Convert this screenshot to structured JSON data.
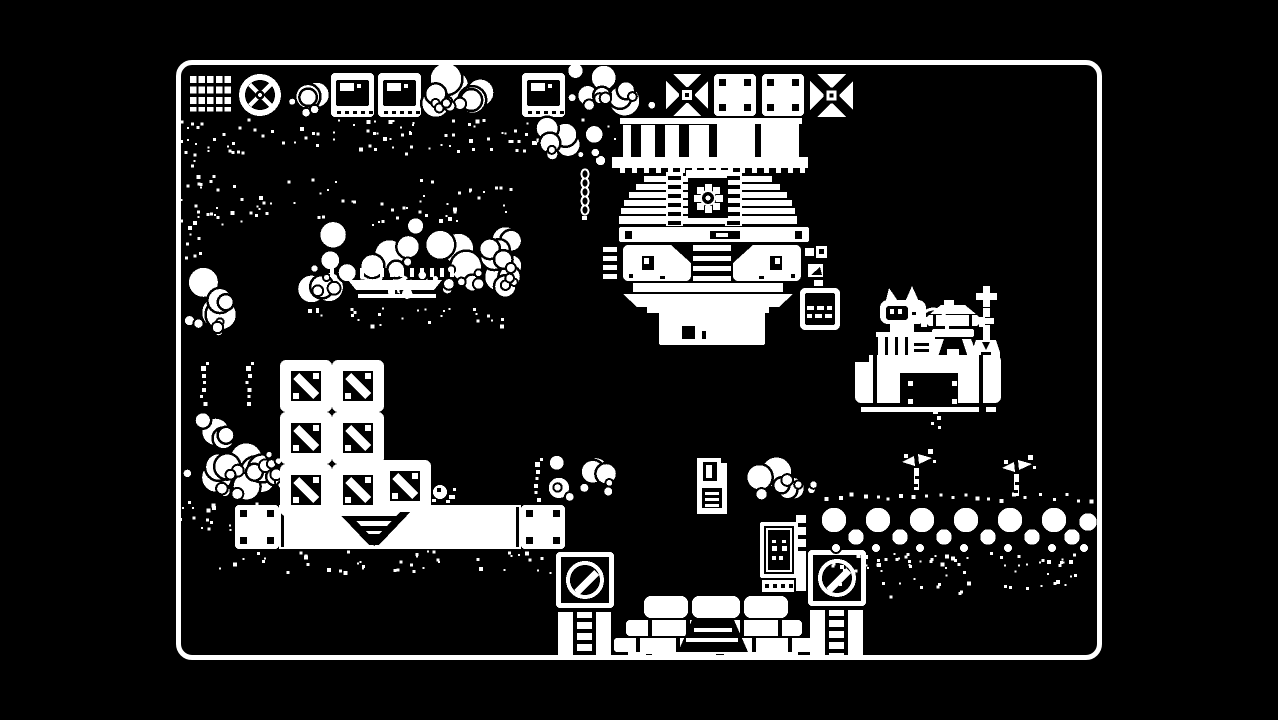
{
  "scene": {
    "description": "1-bit monochrome pixel-art adventure game scene (Minit-style factory area)",
    "colors": {
      "background": "#000000",
      "foreground": "#ffffff"
    },
    "viewport": {
      "x": 176,
      "y": 60,
      "width": 926,
      "height": 600,
      "border_width": 5,
      "border_radius": 16
    },
    "entities": [
      {
        "name": "tile-grid",
        "type": "grid_tile",
        "x": 12,
        "y": 13,
        "w": 44,
        "h": 44
      },
      {
        "name": "tile-wheel",
        "type": "wheel_tile",
        "x": 62,
        "y": 13,
        "w": 44,
        "h": 44
      },
      {
        "name": "foliage-top-a",
        "type": "bubbles",
        "x": 104,
        "y": 10,
        "w": 54,
        "h": 48,
        "seed": 11
      },
      {
        "name": "tile-window-1",
        "type": "window_tile",
        "x": 155,
        "y": 13,
        "w": 43,
        "h": 44
      },
      {
        "name": "tile-window-2",
        "type": "window_tile",
        "x": 202,
        "y": 13,
        "w": 43,
        "h": 44
      },
      {
        "name": "foliage-top-b",
        "type": "bubbles",
        "x": 243,
        "y": 2,
        "w": 102,
        "h": 58,
        "seed": 12
      },
      {
        "name": "tile-window-3",
        "type": "window_tile",
        "x": 346,
        "y": 13,
        "w": 43,
        "h": 44
      },
      {
        "name": "foliage-top-c",
        "type": "bubbles",
        "x": 388,
        "y": 2,
        "w": 100,
        "h": 62,
        "seed": 13
      },
      {
        "name": "tile-x-1",
        "type": "x_tile",
        "x": 490,
        "y": 14,
        "w": 42,
        "h": 42
      },
      {
        "name": "tile-corner-1",
        "type": "corner_tile",
        "x": 538,
        "y": 14,
        "w": 42,
        "h": 42
      },
      {
        "name": "tile-corner-2",
        "type": "corner_tile",
        "x": 586,
        "y": 14,
        "w": 42,
        "h": 42
      },
      {
        "name": "tile-x-2",
        "type": "x_tile",
        "x": 634,
        "y": 14,
        "w": 43,
        "h": 43
      },
      {
        "name": "moss-under-tiles",
        "type": "dither",
        "x": 14,
        "y": 58,
        "w": 430,
        "h": 36,
        "d": 0.05,
        "seed": 21
      },
      {
        "name": "moss-left-edge",
        "type": "dither",
        "x": 0,
        "y": 60,
        "w": 38,
        "h": 150,
        "d": 0.05,
        "seed": 22
      },
      {
        "name": "moss-band-left",
        "type": "dither",
        "x": 18,
        "y": 118,
        "w": 320,
        "h": 46,
        "d": 0.04,
        "seed": 23
      },
      {
        "name": "canopy-mid-left",
        "type": "bubbles",
        "x": 114,
        "y": 148,
        "w": 240,
        "h": 96,
        "seed": 24
      },
      {
        "name": "moss-under-canopy",
        "type": "dither",
        "x": 120,
        "y": 246,
        "w": 230,
        "h": 20,
        "d": 0.05,
        "seed": 25
      },
      {
        "name": "dock-awning",
        "type": "awning",
        "x": 154,
        "y": 206
      },
      {
        "name": "foliage-left-column",
        "type": "bubbles",
        "x": 4,
        "y": 204,
        "w": 62,
        "h": 72,
        "seed": 26
      },
      {
        "name": "foliage-mid",
        "type": "bubbles",
        "x": 358,
        "y": 56,
        "w": 80,
        "h": 56,
        "seed": 27
      },
      {
        "name": "hanging-chain",
        "type": "chain",
        "x": 403,
        "y": 110
      },
      {
        "name": "factory-machine",
        "type": "machine",
        "x": 427,
        "y": 58
      },
      {
        "name": "marquee-sign",
        "type": "marquee",
        "x": 486,
        "y": 254,
        "w": 100,
        "h": 28
      },
      {
        "name": "dot-sign",
        "type": "dot_sign",
        "x": 624,
        "y": 228,
        "w": 40,
        "h": 42
      },
      {
        "name": "cat-npc",
        "type": "cat",
        "x": 704,
        "y": 225
      },
      {
        "name": "grill-machine",
        "type": "grill",
        "x": 750,
        "y": 240
      },
      {
        "name": "lamp-post",
        "type": "lamppost",
        "x": 796,
        "y": 226
      },
      {
        "name": "right-platform",
        "type": "platform_right",
        "x": 679,
        "y": 295,
        "w": 146,
        "h": 48
      },
      {
        "name": "water-drip",
        "type": "drip",
        "x": 753,
        "y": 345
      },
      {
        "name": "hedge-left",
        "type": "bubbles",
        "x": 2,
        "y": 336,
        "w": 112,
        "h": 106,
        "seed": 31
      },
      {
        "name": "moss-under-hedge-left",
        "type": "dither",
        "x": 2,
        "y": 440,
        "w": 116,
        "h": 32,
        "d": 0.06,
        "seed": 32
      },
      {
        "name": "sprout-dots-a",
        "type": "dotstalk",
        "x": 26,
        "y": 306,
        "h": 36,
        "cross": true
      },
      {
        "name": "sprout-dots-b",
        "type": "dotstalk",
        "x": 71,
        "y": 306,
        "h": 36,
        "cross": true
      },
      {
        "name": "left-platform",
        "type": "platform_left",
        "x": 59,
        "y": 445,
        "w": 330,
        "h": 44
      },
      {
        "name": "moss-under-platform",
        "type": "dither",
        "x": 36,
        "y": 490,
        "w": 356,
        "h": 22,
        "d": 0.05,
        "seed": 33
      },
      {
        "name": "crate-1",
        "type": "crate",
        "x": 104,
        "y": 300
      },
      {
        "name": "crate-2",
        "type": "crate",
        "x": 156,
        "y": 300
      },
      {
        "name": "crate-3",
        "type": "crate",
        "x": 104,
        "y": 352
      },
      {
        "name": "crate-4",
        "type": "crate",
        "x": 156,
        "y": 352
      },
      {
        "name": "crate-5",
        "type": "crate",
        "x": 104,
        "y": 404
      },
      {
        "name": "crate-6",
        "type": "crate",
        "x": 156,
        "y": 404
      },
      {
        "name": "crate-7",
        "type": "crate",
        "x": 203,
        "y": 400
      },
      {
        "name": "snail-npc",
        "type": "snail",
        "x": 252,
        "y": 422
      },
      {
        "name": "sprout-dots-right",
        "type": "dotstalk",
        "x": 360,
        "y": 402,
        "h": 42,
        "cross": true
      },
      {
        "name": "floppy-disk-item",
        "type": "floppy",
        "x": 521,
        "y": 398
      },
      {
        "name": "foliage-tower-left",
        "type": "bubbles",
        "x": 364,
        "y": 394,
        "w": 78,
        "h": 52,
        "seed": 34
      },
      {
        "name": "speaker-tower-left",
        "type": "tower",
        "x": 380,
        "y": 492
      },
      {
        "name": "foliage-tower-right",
        "type": "bubbles",
        "x": 568,
        "y": 390,
        "w": 74,
        "h": 54,
        "seed": 35
      },
      {
        "name": "speaker-tower-right",
        "type": "tower",
        "x": 632,
        "y": 490
      },
      {
        "name": "monitor-panel",
        "type": "monitor",
        "x": 584,
        "y": 460
      },
      {
        "name": "landing-pad",
        "type": "landing_pad",
        "x": 434,
        "y": 534
      },
      {
        "name": "berry-hedge-right",
        "type": "hedge",
        "x": 640,
        "y": 430,
        "w": 286
      },
      {
        "name": "sprout-leafy-a",
        "type": "sprout",
        "x": 726,
        "y": 392
      },
      {
        "name": "sprout-leafy-b",
        "type": "sprout",
        "x": 826,
        "y": 398
      }
    ]
  }
}
